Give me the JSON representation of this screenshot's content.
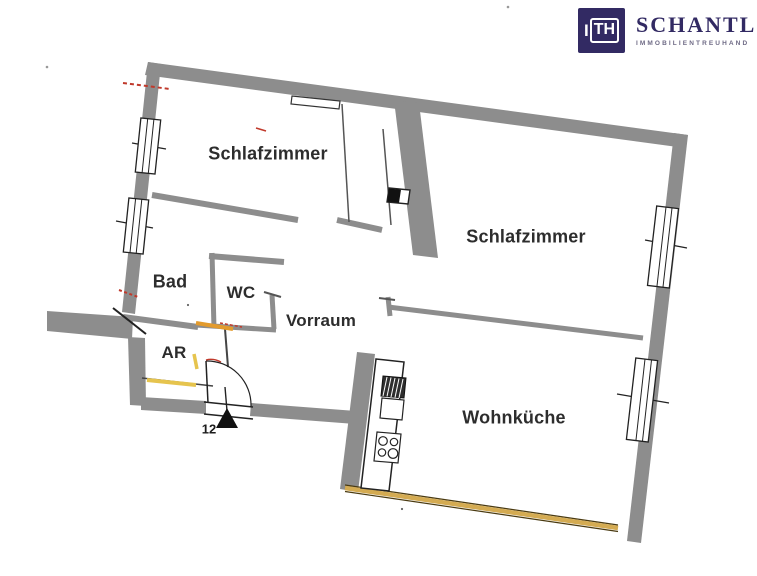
{
  "brand": {
    "mark_i": "I",
    "mark_th": "TH",
    "name": "SCHANTL",
    "tagline": "IMMOBILIENTREUHAND"
  },
  "rooms": [
    {
      "id": "schlafzimmer-left",
      "label": "Schlafzimmer"
    },
    {
      "id": "schlafzimmer-right",
      "label": "Schlafzimmer"
    },
    {
      "id": "bad",
      "label": "Bad"
    },
    {
      "id": "wc",
      "label": "WC"
    },
    {
      "id": "vorraum",
      "label": "Vorraum"
    },
    {
      "id": "abstellraum",
      "label": "AR"
    },
    {
      "id": "wohnkueche",
      "label": "Wohnküche"
    }
  ],
  "entrance": {
    "door_number": "12"
  },
  "colors": {
    "wall": "#8d8d8d",
    "window_band_gold": "#d4ab52",
    "door_threshold_orange": "#e39b2d",
    "threshold_yellow": "#e6c44e",
    "measure_red": "#c0392b",
    "brand_navy": "#322a63"
  }
}
